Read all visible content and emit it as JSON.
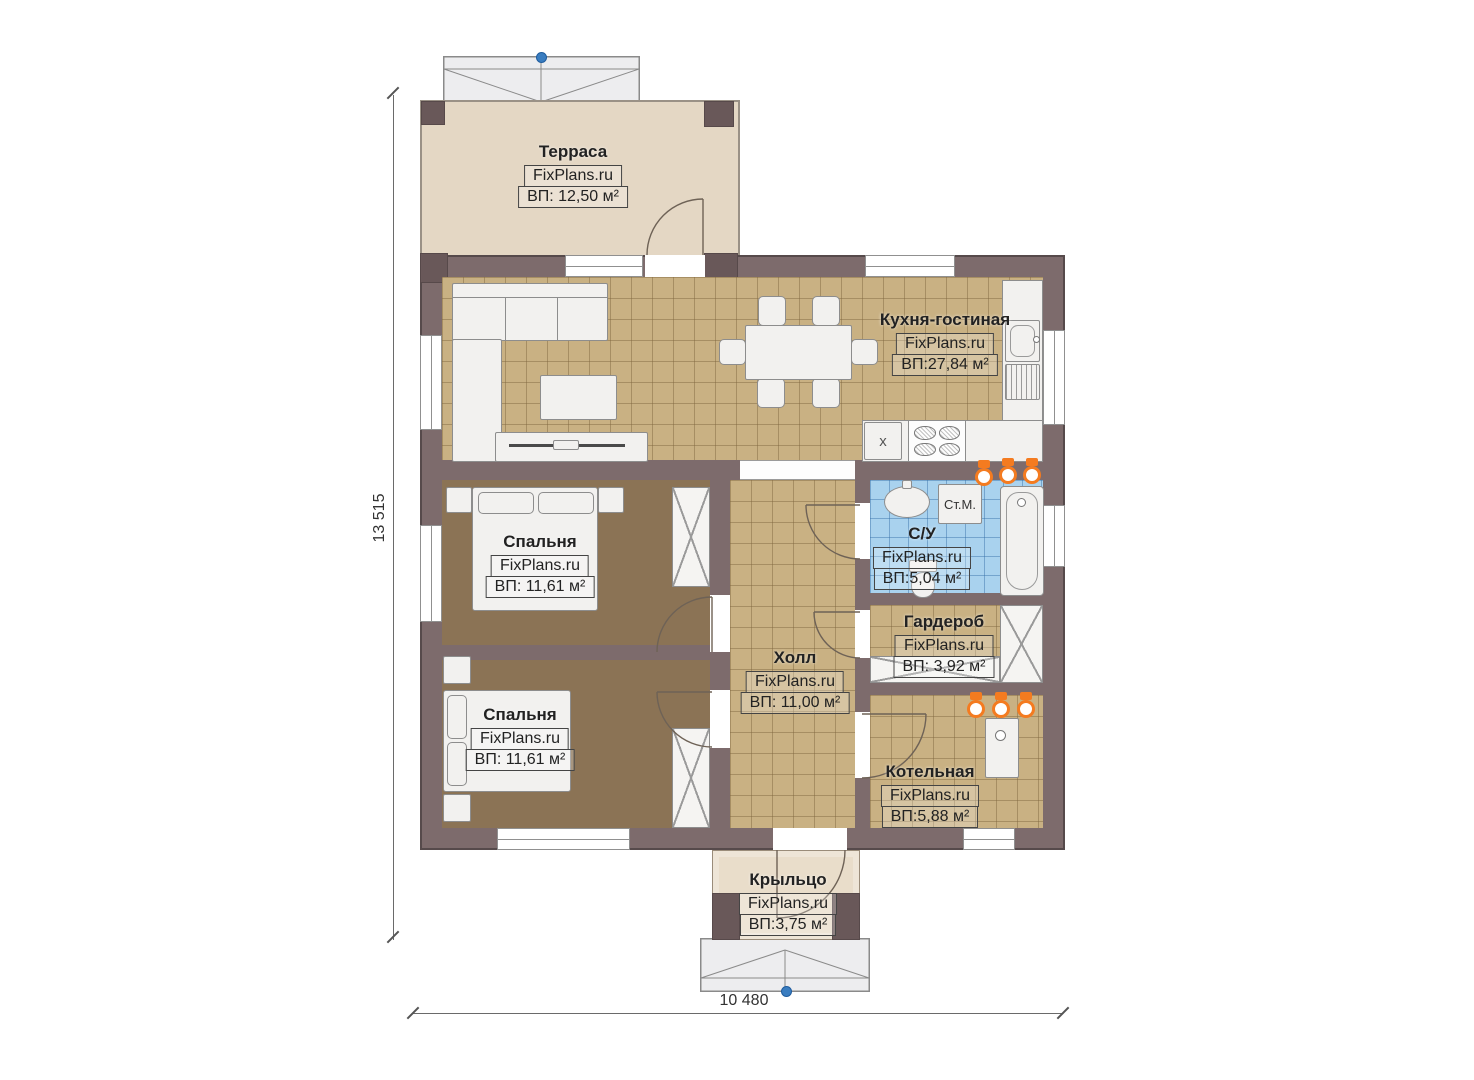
{
  "brand": "FixPlans.ru",
  "rooms": {
    "terrace": {
      "name": "Терраса",
      "brand": "FixPlans.ru",
      "area": "ВП: 12,50 м²"
    },
    "kitchen_living": {
      "name": "Кухня-гостиная",
      "brand": "FixPlans.ru",
      "area": "ВП:27,84 м²"
    },
    "bedroom_1": {
      "name": "Спальня",
      "brand": "FixPlans.ru",
      "area": "ВП: 11,61 м²"
    },
    "bedroom_2": {
      "name": "Спальня",
      "brand": "FixPlans.ru",
      "area": "ВП: 11,61 м²"
    },
    "hall": {
      "name": "Холл",
      "brand": "FixPlans.ru",
      "area": "ВП: 11,00 м²"
    },
    "bathroom": {
      "name": "С/У",
      "brand": "FixPlans.ru",
      "area": "ВП:5,04 м²"
    },
    "wardrobe": {
      "name": "Гардероб",
      "brand": "FixPlans.ru",
      "area": "ВП: 3,92 м²"
    },
    "boiler_room": {
      "name": "Котельная",
      "brand": "FixPlans.ru",
      "area": "ВП:5,88 м²"
    },
    "porch": {
      "name": "Крыльцо",
      "brand": "FixPlans.ru",
      "area": "ВП:3,75 м²"
    }
  },
  "dimensions": {
    "overall_height": "13 515",
    "overall_width": "10 480"
  },
  "annotations": {
    "washing_machine": "Ст.М.",
    "kitchen_sink_mark": "x"
  },
  "colors": {
    "wall": "#7d6b6c",
    "tile_floor": "#c9b183",
    "wood_floor": "#8b7355",
    "bathroom_tile": "#a9d2ee",
    "terrace_floor": "#e4d7c4",
    "porch_floor": "#e9ddca",
    "fixture_orange": "#f47b20",
    "marker_blue": "#3a7dc0"
  }
}
